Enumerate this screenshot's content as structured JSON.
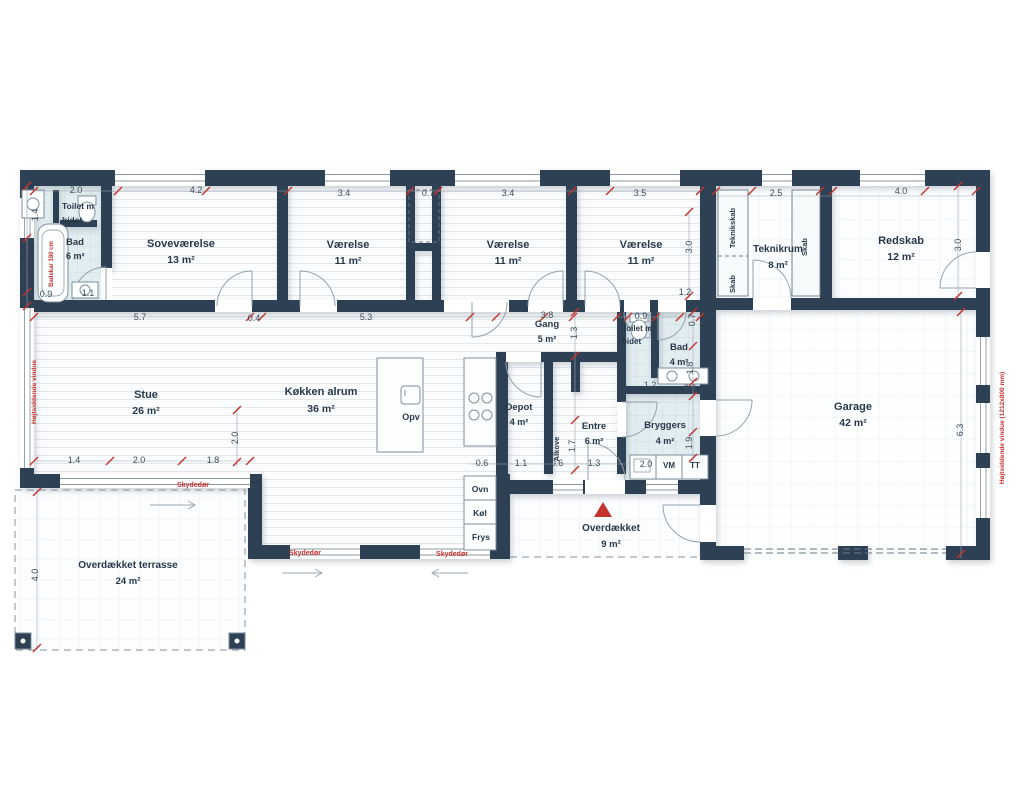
{
  "colors": {
    "wall": "#2e4053",
    "accent_red": "#c4332e",
    "bath_floor": "#e2edf0",
    "line": "#8b99a6"
  },
  "plan": {
    "rooms": [
      {
        "name": "Toilet m",
        "name2": "bidet",
        "area": ""
      },
      {
        "name": "Bad",
        "area": "6 m²"
      },
      {
        "name": "Soveværelse",
        "area": "13 m²"
      },
      {
        "name": "Værelse",
        "area": "11 m²"
      },
      {
        "name": "Værelse",
        "area": "11 m²"
      },
      {
        "name": "Værelse",
        "area": "11 m²"
      },
      {
        "name": "Teknikrum",
        "area": "8 m²"
      },
      {
        "name": "Redskab",
        "area": "12 m²"
      },
      {
        "name": "Stue",
        "area": "26 m²"
      },
      {
        "name": "Køkken alrum",
        "area": "36 m²"
      },
      {
        "name": "Gang",
        "area": "5 m²"
      },
      {
        "name": "Depot",
        "area": "4 m²"
      },
      {
        "name": "Toilet m",
        "name2": "bidet",
        "area": ""
      },
      {
        "name": "Bad",
        "area": "4 m²"
      },
      {
        "name": "Entre",
        "area": "6 m²"
      },
      {
        "name": "Bryggers",
        "area": "4 m²"
      },
      {
        "name": "Garage",
        "area": "42 m²"
      },
      {
        "name": "Overdækket",
        "area": "9 m²"
      },
      {
        "name": "Overdækket terrasse",
        "area": "24 m²"
      }
    ],
    "closets": {
      "teknikskab": "Teknikskab",
      "skab_left": "Skab",
      "skab_right": "Skab",
      "alkove": "Alkove"
    },
    "appliances": {
      "opv": "Opv",
      "ovn": "Ovn",
      "koel": "Køl",
      "frys": "Frys",
      "vm": "VM",
      "tt": "TT"
    },
    "annotations": {
      "skydedoer": "Skydedør",
      "window_note_left": "Højtsiddende vindue",
      "window_note_right": "Højtsiddende vindue (1212x800 mm)",
      "bathtub_note": "Badekar 180 cm"
    },
    "dims": [
      "2.0",
      "4.2",
      "3.4",
      "0.7",
      "3.4",
      "3.5",
      "2.5",
      "4.0",
      "1.4",
      "1.6",
      "0.9",
      "1.1",
      "5.7",
      "0.4",
      "5.3",
      "3.8",
      "1.3",
      "0.9",
      "1.2",
      "0.7",
      "3.0",
      "3.0",
      "6.3",
      "2.0",
      "1.4",
      "2.0",
      "1.8",
      "1.8",
      "1.2",
      "0.9",
      "1.7",
      "1.9",
      "0.6",
      "1.1",
      "0.6",
      "1.3",
      "2.0",
      "4.0"
    ]
  }
}
